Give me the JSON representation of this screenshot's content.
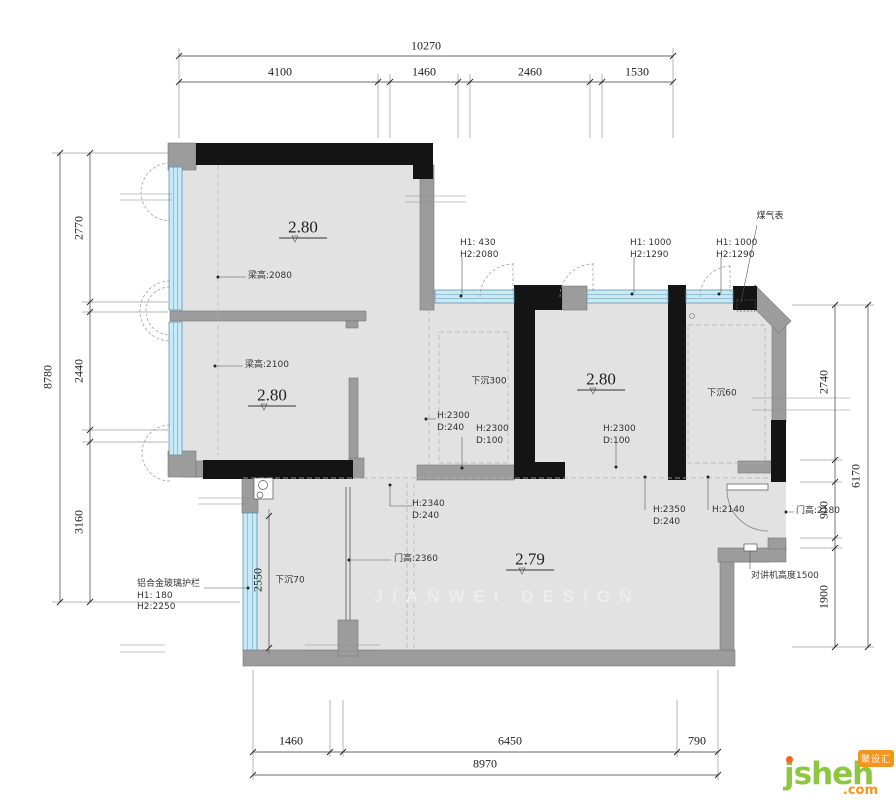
{
  "watermark": {
    "text": "JIANWEI DESIGN"
  },
  "logo": {
    "name": "jsheh",
    "tld": ".com",
    "badge": "聚设汇",
    "green": "#8dc63f",
    "orange": "#f7941d"
  },
  "colors": {
    "floor": "#e2e2e2",
    "wall_black": "#141414",
    "wall_gray": "#9c9c9c",
    "window_fill": "#c8e9f6",
    "window_stroke": "#5d95b0"
  },
  "dimensions_mm": {
    "top": {
      "overall": "10270",
      "segments": [
        "4100",
        "1460",
        "2460",
        "1530"
      ]
    },
    "left": {
      "overall": "8780",
      "segments": [
        "2770",
        "2440",
        "3160"
      ]
    },
    "right": {
      "overall": "6170",
      "segments": [
        "2740",
        "900",
        "1900"
      ]
    },
    "bottom": {
      "overall": "8970",
      "segments": [
        "1460",
        "6450",
        "790"
      ]
    },
    "balcony_width": "2550"
  },
  "floor_levels": [
    "2.80",
    "2.80",
    "2.80",
    "2.79"
  ],
  "labels": [
    {
      "n": "dim-top-overall",
      "t": "10270",
      "x": 426,
      "y": 46,
      "c": "dim"
    },
    {
      "n": "dim-top-4100",
      "t": "4100",
      "x": 280,
      "y": 72,
      "c": "dim"
    },
    {
      "n": "dim-top-1460",
      "t": "1460",
      "x": 424,
      "y": 72,
      "c": "dim"
    },
    {
      "n": "dim-top-2460",
      "t": "2460",
      "x": 530,
      "y": 72,
      "c": "dim"
    },
    {
      "n": "dim-top-1530",
      "t": "1530",
      "x": 637,
      "y": 72,
      "c": "dim"
    },
    {
      "n": "dim-left-overall",
      "t": "8780",
      "x": 48,
      "y": 377,
      "c": "dimv"
    },
    {
      "n": "dim-left-2770",
      "t": "2770",
      "x": 79,
      "y": 228,
      "c": "dimv"
    },
    {
      "n": "dim-left-2440",
      "t": "2440",
      "x": 79,
      "y": 371,
      "c": "dimv"
    },
    {
      "n": "dim-left-3160",
      "t": "3160",
      "x": 79,
      "y": 522,
      "c": "dimv"
    },
    {
      "n": "dim-right-2740",
      "t": "2740",
      "x": 824,
      "y": 382,
      "c": "dimv"
    },
    {
      "n": "dim-right-900",
      "t": "900",
      "x": 824,
      "y": 510,
      "c": "dimv"
    },
    {
      "n": "dim-right-1900",
      "t": "1900",
      "x": 824,
      "y": 597,
      "c": "dimv"
    },
    {
      "n": "dim-right-overall",
      "t": "6170",
      "x": 856,
      "y": 476,
      "c": "dimv"
    },
    {
      "n": "dim-bottom-1460",
      "t": "1460",
      "x": 291,
      "y": 741,
      "c": "dim"
    },
    {
      "n": "dim-bottom-6450",
      "t": "6450",
      "x": 510,
      "y": 741,
      "c": "dim"
    },
    {
      "n": "dim-bottom-790",
      "t": "790",
      "x": 697,
      "y": 741,
      "c": "dim"
    },
    {
      "n": "dim-bottom-overall",
      "t": "8970",
      "x": 485,
      "y": 764,
      "c": "dim"
    },
    {
      "n": "dim-balcony-2550",
      "t": "2550",
      "x": 258,
      "y": 580,
      "c": "dimv"
    },
    {
      "n": "level-bedroom-1",
      "t": "2.80",
      "x": 303,
      "y": 228,
      "c": "level"
    },
    {
      "n": "level-bedroom-2",
      "t": "2.80",
      "x": 272,
      "y": 396,
      "c": "level"
    },
    {
      "n": "level-dining",
      "t": "2.80",
      "x": 601,
      "y": 380,
      "c": "level"
    },
    {
      "n": "level-living",
      "t": "2.79",
      "x": 530,
      "y": 560,
      "c": "level"
    },
    {
      "n": "ann-gas-meter",
      "t": "煤气表",
      "x": 770,
      "y": 217,
      "c": "ann"
    },
    {
      "n": "ann-window-1",
      "t": "H1: 430\nH2:2080",
      "x": 460,
      "y": 238,
      "c": "annL"
    },
    {
      "n": "ann-window-2",
      "t": "H1: 1000\nH2:1290",
      "x": 630,
      "y": 238,
      "c": "annL"
    },
    {
      "n": "ann-window-3",
      "t": "H1: 1000\nH2:1290",
      "x": 716,
      "y": 238,
      "c": "annL"
    },
    {
      "n": "ann-beam-2080",
      "t": "梁高:2080",
      "x": 248,
      "y": 271,
      "c": "annL"
    },
    {
      "n": "ann-beam-2100",
      "t": "梁高:2100",
      "x": 245,
      "y": 360,
      "c": "annL"
    },
    {
      "n": "ann-sunken-300",
      "t": "下沉300",
      "x": 489,
      "y": 382,
      "c": "ann"
    },
    {
      "n": "ann-sunken-60",
      "t": "下沉60",
      "x": 722,
      "y": 394,
      "c": "ann"
    },
    {
      "n": "ann-sunken-70",
      "t": "下沉70",
      "x": 290,
      "y": 581,
      "c": "ann"
    },
    {
      "n": "ann-opening-1",
      "t": "H:2300\nD:240",
      "x": 437,
      "y": 411,
      "c": "annL"
    },
    {
      "n": "ann-opening-2",
      "t": "H:2300\nD:100",
      "x": 476,
      "y": 424,
      "c": "annL"
    },
    {
      "n": "ann-opening-3",
      "t": "H:2300\nD:100",
      "x": 603,
      "y": 424,
      "c": "annL"
    },
    {
      "n": "ann-opening-4",
      "t": "H:2340\nD:240",
      "x": 412,
      "y": 499,
      "c": "annL"
    },
    {
      "n": "ann-door-2360",
      "t": "门高:2360",
      "x": 394,
      "y": 554,
      "c": "annL"
    },
    {
      "n": "ann-opening-5",
      "t": "H:2350\nD:240",
      "x": 653,
      "y": 505,
      "c": "annL"
    },
    {
      "n": "ann-opening-6",
      "t": "H:2140",
      "x": 712,
      "y": 505,
      "c": "annL"
    },
    {
      "n": "ann-door-2180",
      "t": "门高:2180",
      "x": 796,
      "y": 506,
      "c": "annL"
    },
    {
      "n": "ann-intercom",
      "t": "对讲机高度1500",
      "x": 751,
      "y": 571,
      "c": "annL"
    },
    {
      "n": "ann-railing",
      "t": "铝合金玻璃护栏\nH1: 180\nH2:2250",
      "x": 137,
      "y": 579,
      "c": "annL"
    }
  ]
}
